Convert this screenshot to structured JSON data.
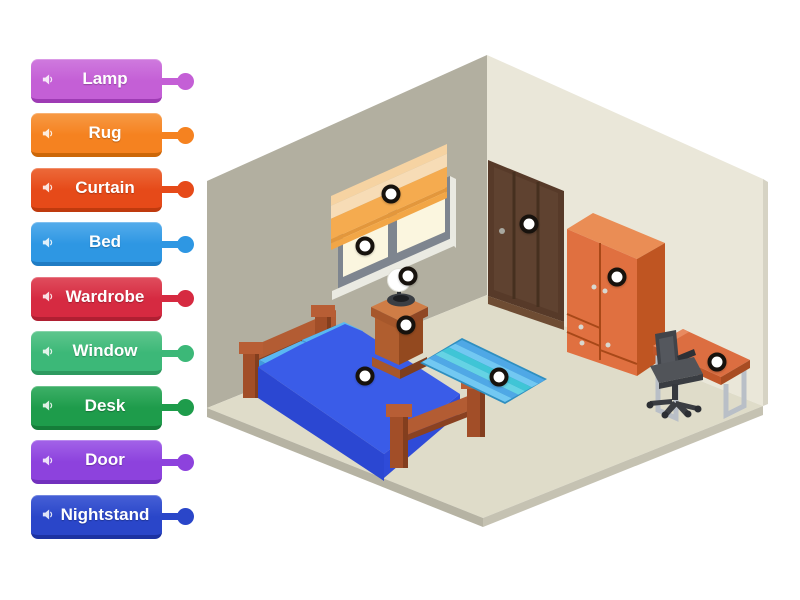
{
  "page": {
    "background": "#ffffff"
  },
  "labels": [
    {
      "id": "lamp",
      "text": "Lamp",
      "color": "#c45fd6",
      "color_light": "#cf7ade",
      "color_dark": "#9e3bb4"
    },
    {
      "id": "rug",
      "text": "Rug",
      "color": "#f58220",
      "color_light": "#f79a45",
      "color_dark": "#cc6708"
    },
    {
      "id": "curtain",
      "text": "Curtain",
      "color": "#e64a19",
      "color_light": "#ec6a3a",
      "color_dark": "#bf3a0e"
    },
    {
      "id": "bed",
      "text": "Bed",
      "color": "#2e97e3",
      "color_light": "#55aceb",
      "color_dark": "#1f7cc4"
    },
    {
      "id": "wardrobe",
      "text": "Wardrobe",
      "color": "#d62a41",
      "color_light": "#e04e5e",
      "color_dark": "#b01f32"
    },
    {
      "id": "window",
      "text": "Window",
      "color": "#3cb878",
      "color_light": "#5fc68e",
      "color_dark": "#2d9a5f"
    },
    {
      "id": "desk",
      "text": "Desk",
      "color": "#1e9c4b",
      "color_light": "#3eb068",
      "color_dark": "#157d39"
    },
    {
      "id": "door",
      "text": "Door",
      "color": "#8d42dd",
      "color_light": "#a363e8",
      "color_dark": "#7230bd"
    },
    {
      "id": "nightstand",
      "text": "Nightstand",
      "color": "#2a46c9",
      "color_light": "#4660d6",
      "color_dark": "#1c32a2"
    }
  ],
  "pins": [
    {
      "id": "curtain",
      "x": 391,
      "y": 194
    },
    {
      "id": "window",
      "x": 365,
      "y": 246
    },
    {
      "id": "door",
      "x": 529,
      "y": 224
    },
    {
      "id": "wardrobe",
      "x": 617,
      "y": 277
    },
    {
      "id": "lamp",
      "x": 408,
      "y": 276
    },
    {
      "id": "nightstand",
      "x": 406,
      "y": 325
    },
    {
      "id": "bed",
      "x": 365,
      "y": 376
    },
    {
      "id": "rug",
      "x": 499,
      "y": 377
    },
    {
      "id": "desk",
      "x": 717,
      "y": 362
    }
  ],
  "scene": {
    "left_wall_color": "#b2afa0",
    "right_wall_color": "#eae7d9",
    "floor_color": "#dfdcc9",
    "platform_edge_color": "#b6b3a3",
    "objects": [
      "curtain",
      "window",
      "door",
      "wardrobe",
      "lamp",
      "nightstand",
      "bed",
      "rug",
      "desk",
      "chair"
    ]
  }
}
